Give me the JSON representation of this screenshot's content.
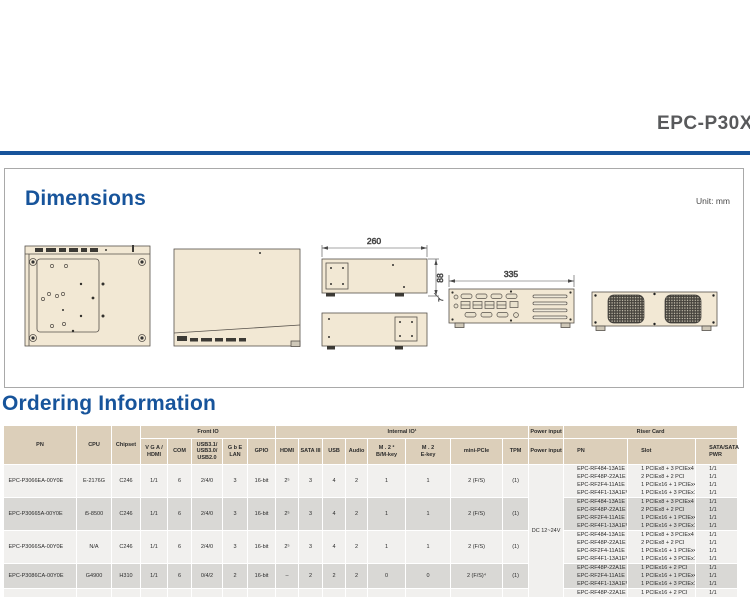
{
  "page": {
    "title": "EPC-P30X0",
    "accent_color": "#17549b"
  },
  "dimensions_section": {
    "heading": "Dimensions",
    "unit_label": "Unit: mm",
    "dims": {
      "width": "260",
      "height": "88",
      "foot": "7",
      "length": "335"
    }
  },
  "ordering_section": {
    "heading": "Ordering Information",
    "table": {
      "groups": {
        "front_io": "Front IO",
        "internal_io": "Internal IO¹",
        "power_input": "Power input",
        "riser_card": "Riser Card"
      },
      "headers": {
        "pn": "PN",
        "cpu": "CPU",
        "chipset": "Chipset",
        "vga_hdmi": "V G A /\nHDMI",
        "com": "COM",
        "usb_front": "USB3.1/\nUSB3.0/\nUSB2.0",
        "gbe_lan": "G b E\nLAN",
        "gpio": "GPIO",
        "hdmi": "HDMI",
        "sata3": "SATA III",
        "usb": "USB",
        "audio": "Audio",
        "m2_bm": "M . 2 ²\nB/M-key",
        "m2_e": "M . 2\nE-key",
        "mini_pcie": "mini-PCIe",
        "tpm": "TPM",
        "power_input": "Power input",
        "riser_pn": "PN",
        "riser_slot": "Slot",
        "riser_sata": "SATA/SATA\nPWR"
      },
      "main_keys": [
        "pn",
        "cpu",
        "chipset",
        "vga_hdmi",
        "com",
        "usb_front",
        "gbe_lan",
        "gpio",
        "hdmi",
        "sata3",
        "usb",
        "audio",
        "m2_bm",
        "m2_e",
        "mini_pcie",
        "tpm"
      ],
      "power_value": "DC 12~24V",
      "rows": [
        {
          "pn": "EPC-P3066EA-00Y0E",
          "cpu": "E-2176G",
          "chipset": "C246",
          "vga_hdmi": "1/1",
          "com": "6",
          "usb_front": "2/4/0",
          "gbe_lan": "3",
          "gpio": "16-bit",
          "hdmi": "2⁵",
          "sata3": "3",
          "usb": "4",
          "audio": "2",
          "m2_bm": "1",
          "m2_e": "1",
          "mini_pcie": "2 (F/S)",
          "tpm": "(1)",
          "risers": [
            {
              "pn": "EPC-RF484-13A1E",
              "slot": "1 PCIEx8 + 3 PCIEx4",
              "sata": "1/1"
            },
            {
              "pn": "EPC-RF48P-22A1E",
              "slot": "2 PCIEx8 + 2 PCI",
              "sata": "1/1"
            },
            {
              "pn": "EPC-RF2F4-11A1E",
              "slot": "1 PCIEx16 + 1 PCIEx4",
              "sata": "1/1"
            },
            {
              "pn": "EPC-RF4F1-13A1E³",
              "slot": "1 PCIEx16 + 3 PCIEx1",
              "sata": "1/1"
            }
          ]
        },
        {
          "pn": "EPC-P30665A-00Y0E",
          "cpu": "i5-8500",
          "chipset": "C246",
          "vga_hdmi": "1/1",
          "com": "6",
          "usb_front": "2/4/0",
          "gbe_lan": "3",
          "gpio": "16-bit",
          "hdmi": "2⁵",
          "sata3": "3",
          "usb": "4",
          "audio": "2",
          "m2_bm": "1",
          "m2_e": "1",
          "mini_pcie": "2 (F/S)",
          "tpm": "(1)",
          "risers": [
            {
              "pn": "EPC-RF484-13A1E",
              "slot": "1 PCIEx8 + 3 PCIEx4",
              "sata": "1/1"
            },
            {
              "pn": "EPC-RF48P-22A1E",
              "slot": "2 PCIEx8 + 2 PCI",
              "sata": "1/1"
            },
            {
              "pn": "EPC-RF2F4-11A1E",
              "slot": "1 PCIEx16 + 1 PCIEx4",
              "sata": "1/1"
            },
            {
              "pn": "EPC-RF4F1-13A1E³",
              "slot": "1 PCIEx16 + 3 PCIEx1",
              "sata": "1/1"
            }
          ]
        },
        {
          "pn": "EPC-P3066SA-00Y0E",
          "cpu": "N/A",
          "chipset": "C246",
          "vga_hdmi": "1/1",
          "com": "6",
          "usb_front": "2/4/0",
          "gbe_lan": "3",
          "gpio": "16-bit",
          "hdmi": "2⁵",
          "sata3": "3",
          "usb": "4",
          "audio": "2",
          "m2_bm": "1",
          "m2_e": "1",
          "mini_pcie": "2 (F/S)",
          "tpm": "(1)",
          "risers": [
            {
              "pn": "EPC-RF484-13A1E",
              "slot": "1 PCIEx8 + 3 PCIEx4",
              "sata": "1/1"
            },
            {
              "pn": "EPC-RF48P-22A1E",
              "slot": "2 PCIEx8 + 2 PCI",
              "sata": "1/1"
            },
            {
              "pn": "EPC-RF2F4-11A1E",
              "slot": "1 PCIEx16 + 1 PCIEx4",
              "sata": "1/1"
            },
            {
              "pn": "EPC-RF4F1-13A1E³",
              "slot": "1 PCIEx16 + 3 PCIEx1",
              "sata": "1/1"
            }
          ]
        },
        {
          "pn": "EPC-P3086CA-00Y0E",
          "cpu": "G4900",
          "chipset": "H310",
          "vga_hdmi": "1/1",
          "com": "6",
          "usb_front": "0/4/2",
          "gbe_lan": "2",
          "gpio": "16-bit",
          "hdmi": "–",
          "sata3": "2",
          "usb": "2",
          "audio": "2",
          "m2_bm": "0",
          "m2_e": "0",
          "mini_pcie": "2 (F/S)⁴",
          "tpm": "(1)",
          "risers": [
            {
              "pn": "EPC-RF48P-22A1E",
              "slot": "1 PCIEx16 + 2 PCI",
              "sata": "1/1"
            },
            {
              "pn": "EPC-RF2F4-11A1E",
              "slot": "1 PCIEx16 + 1 PCIEx4",
              "sata": "1/1"
            },
            {
              "pn": "EPC-RF4F1-13A1E³",
              "slot": "1 PCIEx16 + 3 PCIEx1",
              "sata": "1/1"
            }
          ]
        },
        {
          "pn": "",
          "cpu": "",
          "chipset": "",
          "vga_hdmi": "",
          "com": "",
          "usb_front": "",
          "gbe_lan": "",
          "gpio": "",
          "hdmi": "",
          "sata3": "",
          "usb": "",
          "audio": "",
          "m2_bm": "",
          "m2_e": "",
          "mini_pcie": "",
          "tpm": "",
          "risers": [
            {
              "pn": "EPC-RF48P-22A1E",
              "slot": "1 PCIEx16 + 2 PCI",
              "sata": "1/1"
            }
          ]
        }
      ]
    }
  }
}
